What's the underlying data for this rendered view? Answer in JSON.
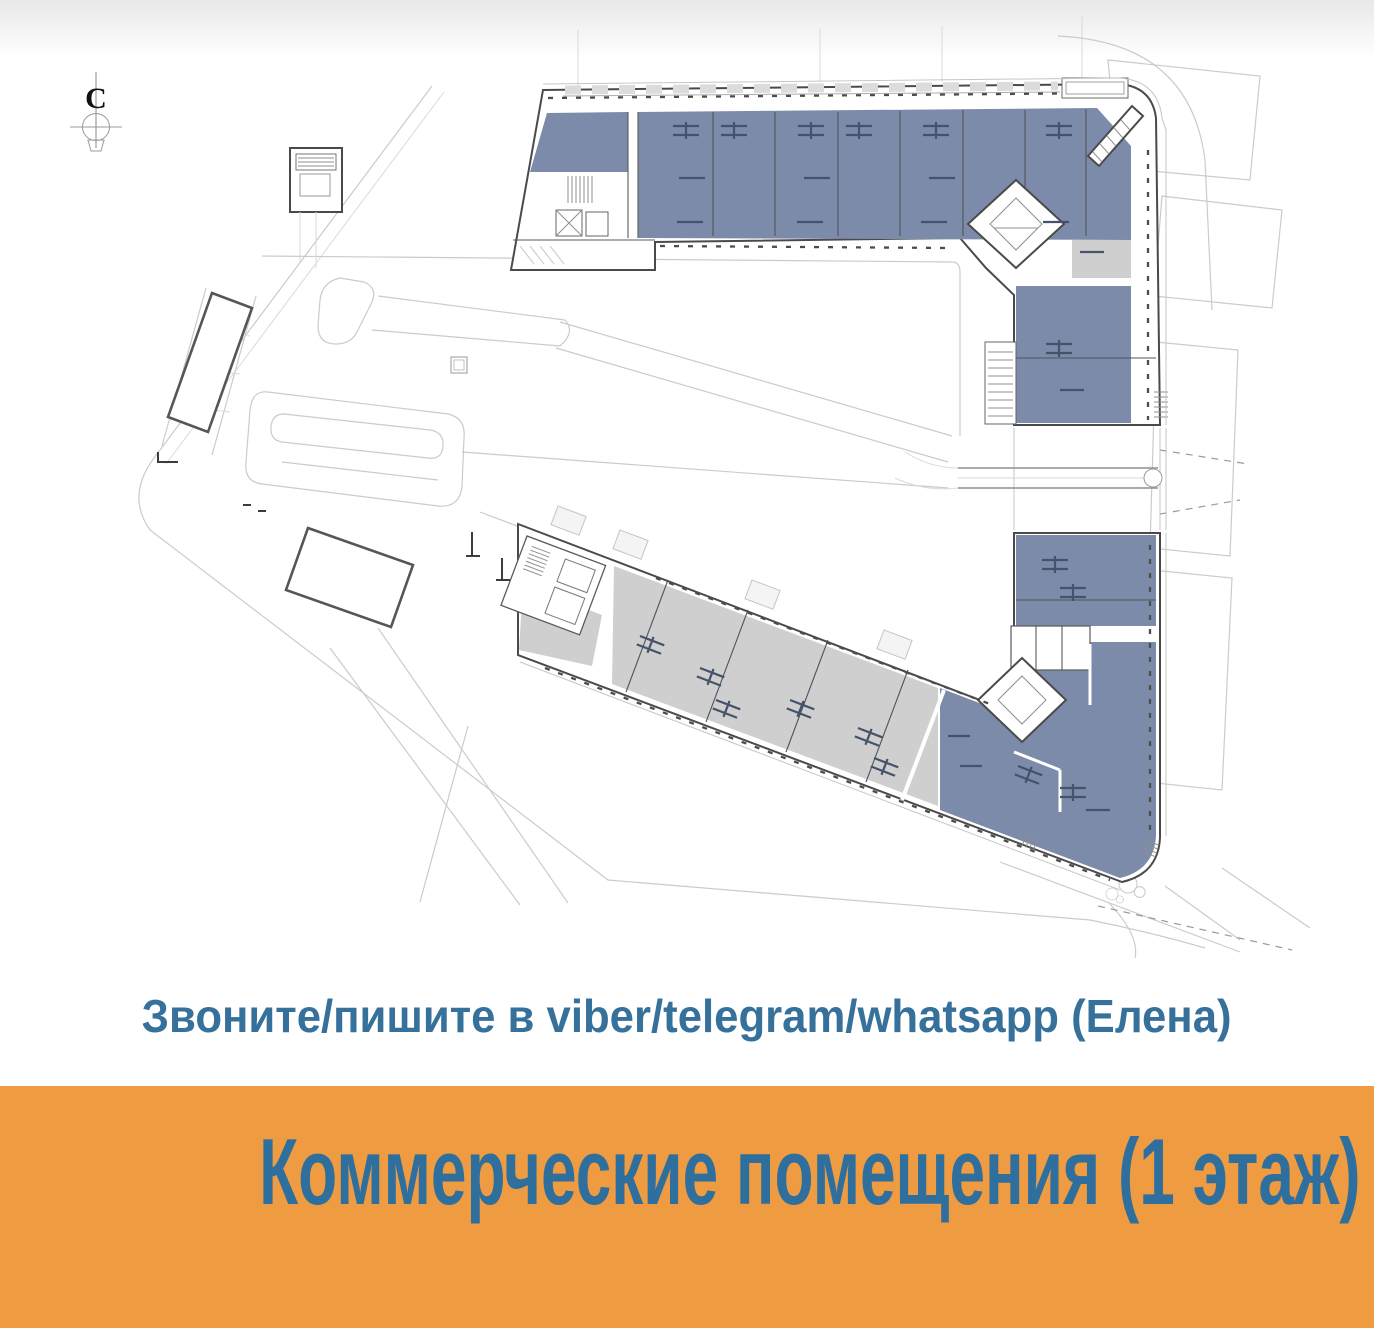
{
  "compass": {
    "label": "С"
  },
  "contact": {
    "text": "Звоните/пишите в viber/telegram/whatsapp (Елена)"
  },
  "banner": {
    "text": "Коммерческие помещения (1 этаж)"
  },
  "colors": {
    "page_bg": "#ffffff",
    "unit_blue": "#7c8ba9",
    "unit_gray": "#cfcfcf",
    "wall": "#4a4a4a",
    "road": "#cbcbcb",
    "accent_orange": "#ee9b41",
    "text_blue": "#36719b",
    "banner_text": "#2e6f9e"
  }
}
